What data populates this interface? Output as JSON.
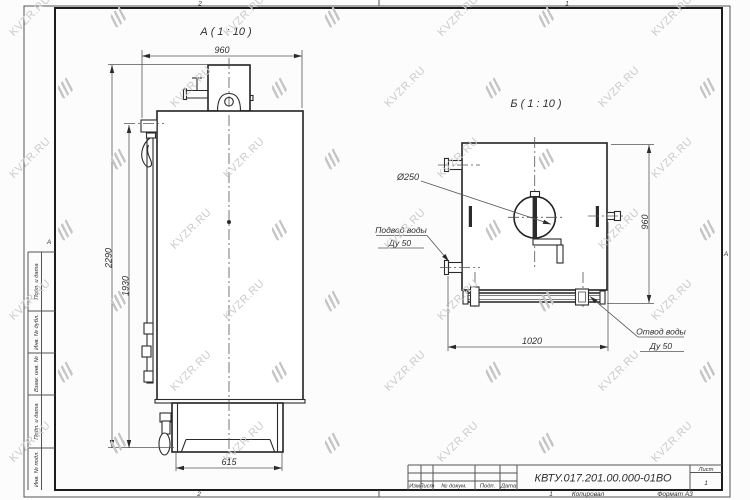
{
  "watermark": {
    "text": "KVZR.RU"
  },
  "sheet": {
    "zone_top_left": "2",
    "zone_top_right": "1",
    "zone_bottom_left": "2",
    "zone_bottom_right": "1",
    "zone_side_left": "А",
    "zone_side_right": "А",
    "margin_labels": [
      "Подп. и дата",
      "Инв. № дубл.",
      "Взам. инв. №",
      "Подп. и дата",
      "Инв. № подл."
    ]
  },
  "views": {
    "a": {
      "title": "А ( 1 : 10 )"
    },
    "b": {
      "title": "Б ( 1 : 10 )"
    }
  },
  "dimensions": {
    "a_depth": "960",
    "a_height_overall": "2290",
    "a_height_body": "1930",
    "a_base_width": "615",
    "b_width": "1020",
    "b_height": "960",
    "b_diameter": "Ø250"
  },
  "callouts": {
    "inlet_line1": "Подвод воды",
    "inlet_line2": "Ду 50",
    "outlet_line1": "Отвод воды",
    "outlet_line2": "Ду 50"
  },
  "title_block": {
    "doc_number": "КВТУ.017.201.00.000-01ВО",
    "columns": [
      "Изм",
      "Лист",
      "№ докум.",
      "Подп.",
      "Дата"
    ],
    "sheet_label": "Лист",
    "sheet_number": "1",
    "copied_label": "Копировал",
    "format_label": "Формат А3"
  }
}
